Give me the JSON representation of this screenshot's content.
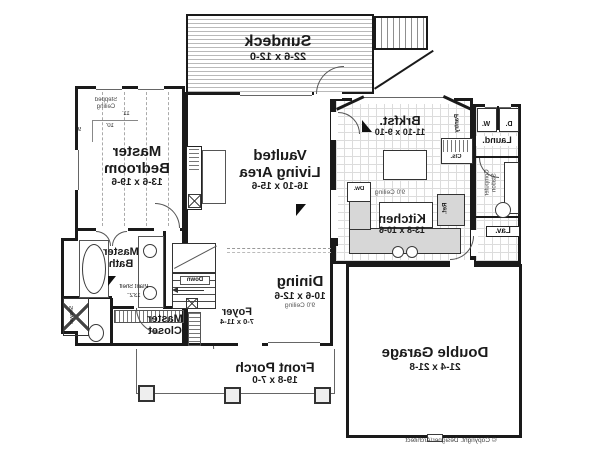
{
  "rooms": {
    "sundeck": {
      "name": "Sundeck",
      "dims": "22-6 x 12-0"
    },
    "master_bedroom": {
      "lines": [
        "Master",
        "Bedroom"
      ],
      "dims": "13-6 x 19-6"
    },
    "living": {
      "lines": [
        "Vaulted",
        "Living Area"
      ],
      "dims": "16-10 x 15-6"
    },
    "brkfst": {
      "name": "Brkfst.",
      "dims": "11-10 x 9-10"
    },
    "kitchen": {
      "name": "Kitchen",
      "dims": "13-8 x 10-6"
    },
    "dining": {
      "name": "Dining",
      "dims": "10-6 x 12-6",
      "ceiling": "9'0 Ceiling"
    },
    "foyer": {
      "name": "Foyer",
      "dims": "7-0 x 11-4"
    },
    "master_bath": {
      "lines": [
        "Master",
        "Bath"
      ]
    },
    "master_closet": {
      "lines": [
        "Master",
        "Closet"
      ]
    },
    "front_porch": {
      "name": "Front Porch",
      "dims": "19-8 x 7-0"
    },
    "garage": {
      "name": "Double Garage",
      "dims": "21-4 x 21-8"
    },
    "laundry": {
      "name": "Laund."
    },
    "lav": {
      "name": "Lav."
    }
  },
  "annotations": {
    "stepped_ceiling": [
      "Stepped",
      "Ceiling"
    ],
    "h11": "11'",
    "h10": "10'",
    "h9": "9'",
    "kitchen_ceiling": "9'0 Ceiling",
    "washer": "W.",
    "dryer": "D.",
    "pantry": "Pantry",
    "cls": "Cls.",
    "computer_station": [
      "Computer",
      "Station"
    ],
    "ref": "Ref.",
    "dw": "Dw.",
    "down": "Down",
    "shower": "Shower",
    "plant_shelf": "Plant Shelf",
    "plant_shelf_height": "13'2\"",
    "copyright": "© Copyright. Designer/Architect"
  },
  "colors": {
    "line": "#1a1a1a",
    "counter_fill": "#d7d7d7",
    "deck_line": "#b9b9b9"
  }
}
